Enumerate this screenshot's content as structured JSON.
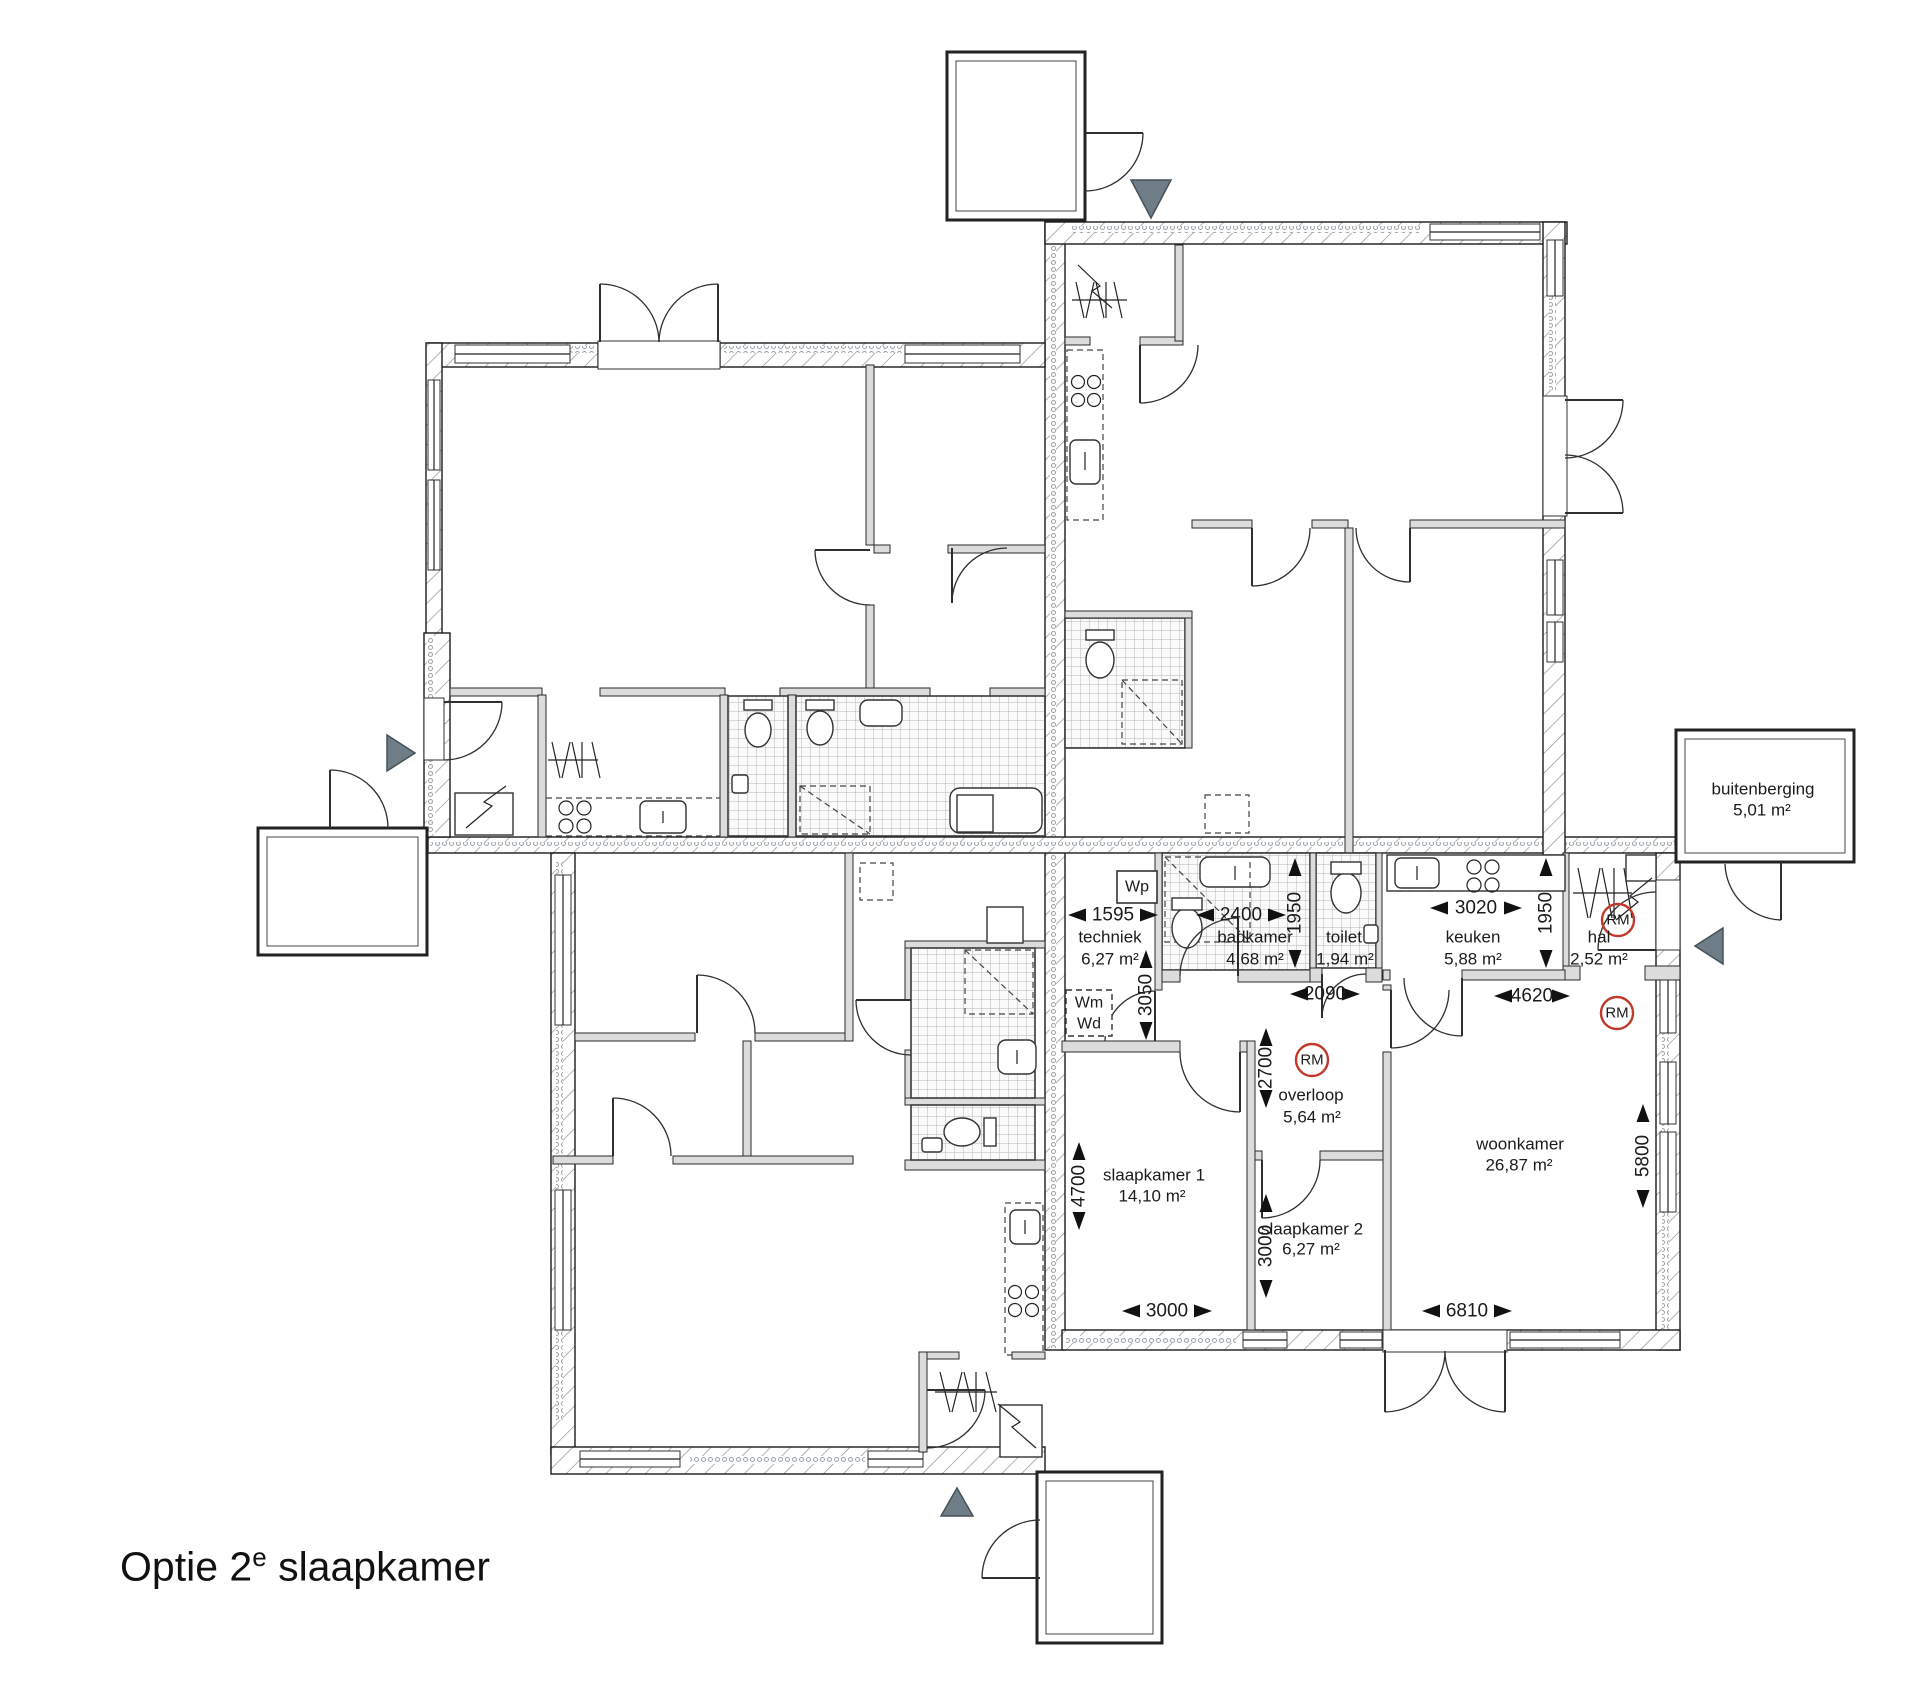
{
  "title": {
    "pre": "Optie 2",
    "sup": "e",
    "post": " slaapkamer"
  },
  "rooms": [
    {
      "name": "techniek",
      "area": "6,27 m²"
    },
    {
      "name": "badkamer",
      "area": "4,68 m²"
    },
    {
      "name": "toilet",
      "area": "1,94 m²"
    },
    {
      "name": "keuken",
      "area": "5,88 m²"
    },
    {
      "name": "hal",
      "area": "2,52 m²"
    },
    {
      "name": "overloop",
      "area": "5,64 m²"
    },
    {
      "name": "slaapkamer 1",
      "area": "14,10 m²"
    },
    {
      "name": "slaapkamer 2",
      "area": "6,27 m²"
    },
    {
      "name": "woonkamer",
      "area": "26,87 m²"
    },
    {
      "name": "buitenberging",
      "area": "5,01 m²"
    }
  ],
  "dimensions": {
    "techniek_width": "1595",
    "badkamer_width": "2400",
    "badkamer_depth": "1950",
    "techniek_depth": "3050",
    "overloop_width": "2090",
    "keuken_width": "3020",
    "keuken_depth": "1950",
    "woonkamer_width": "4620",
    "overloop_depth": "2700",
    "slaapkamer1_width": "3000",
    "slaapkamer1_depth": "4700",
    "slaapkamer2_depth": "3000",
    "entry_width": "6810",
    "woonkamer_depth": "5800"
  },
  "markers": {
    "wp": "Wp",
    "wm": "Wm",
    "wd": "Wd",
    "rm": "RM"
  },
  "colors": {
    "rm_badge": "#c0392b",
    "entrance_marker": "#6f7d86"
  }
}
